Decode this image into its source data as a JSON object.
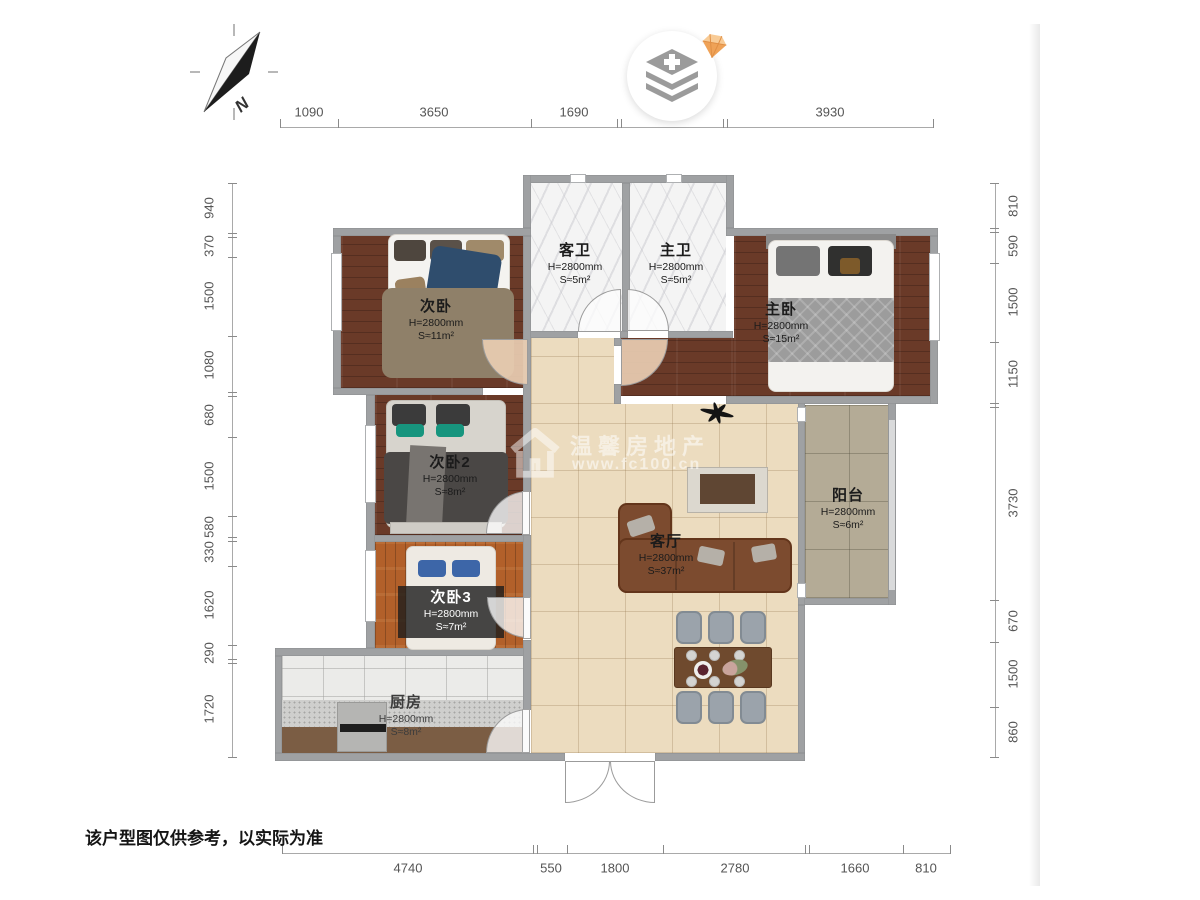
{
  "compass": {
    "label": "N"
  },
  "disclaimer": "该户型图仅供参考，以实际为准",
  "watermark": {
    "brand": "温馨房地产",
    "url": "www.fc100.cn"
  },
  "dimensions": {
    "top": [
      "1090",
      "3650",
      "1690",
      "3930"
    ],
    "left": [
      "940",
      "370",
      "1500",
      "1080",
      "680",
      "1500",
      "580",
      "330",
      "1620",
      "290",
      "1720"
    ],
    "right": [
      "810",
      "590",
      "1500",
      "1150",
      "3730",
      "670",
      "1500",
      "860"
    ],
    "bottom": [
      "4740",
      "550",
      "1800",
      "2780",
      "1660",
      "810"
    ]
  },
  "rooms": [
    {
      "name": "次卧",
      "height": "H=2800mm",
      "area": "S≈11m²"
    },
    {
      "name": "客卫",
      "height": "H=2800mm",
      "area": "S≈5m²"
    },
    {
      "name": "主卫",
      "height": "H=2800mm",
      "area": "S≈5m²"
    },
    {
      "name": "主卧",
      "height": "H=2800mm",
      "area": "S≈15m²"
    },
    {
      "name": "次卧2",
      "height": "H=2800mm",
      "area": "S≈8m²"
    },
    {
      "name": "阳台",
      "height": "H=2800mm",
      "area": "S≈6m²"
    },
    {
      "name": "客厅",
      "height": "H=2800mm",
      "area": "S≈37m²"
    },
    {
      "name": "次卧3",
      "height": "H=2800mm",
      "area": "S≈7m²"
    },
    {
      "name": "厨房",
      "height": "H=2800mm",
      "area": "S≈8m²"
    }
  ],
  "icons": {
    "north_arrow": "north-arrow-icon",
    "layers_badge": "layers-plus-icon",
    "gem": "diamond-gem-icon",
    "ceiling_fan": "fan-icon",
    "house_watermark": "house-icon"
  },
  "colors": {
    "wall": "#9fa1a3",
    "dark_wood": "#6a3a28",
    "orange_wood": "#b2602a",
    "hall_tile": "#ecdcbf",
    "balcony_tile": "#b4ab96",
    "bath_marble": "#f4f4f4",
    "kitchen_tile": "#ebebe9",
    "gem_orange": "#efa257",
    "dimension_text": "#555555"
  }
}
